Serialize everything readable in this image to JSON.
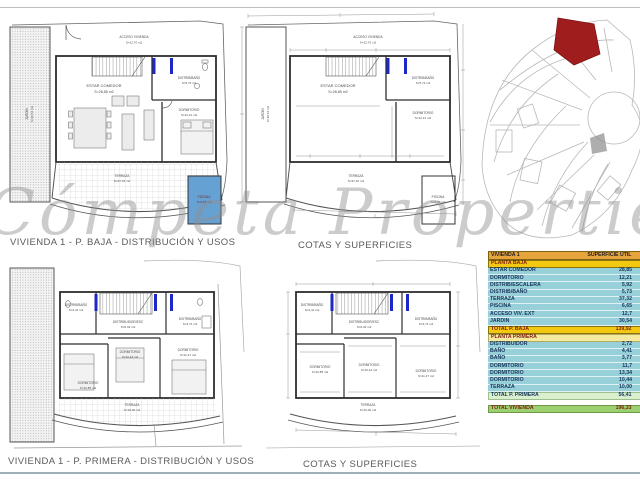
{
  "watermark": "Cómpeta Properties",
  "captions": {
    "pb_usos": "VIVIENDA 1 - P. BAJA - DISTRIBUCIÓN Y USOS",
    "pb_cotas": "COTAS Y SUPERFICIES",
    "pp_usos": "VIVIENDA 1 - P. PRIMERA - DISTRIBUCIÓN Y USOS",
    "pp_cotas": "COTAS Y SUPERFICIES"
  },
  "plans": {
    "pb": {
      "acceso": {
        "name": "ACCESO VIVIENDA",
        "area": "S=12,70 m2"
      },
      "jardin": {
        "name": "JARDÍN",
        "area": "S=30,54 m2"
      },
      "estar": {
        "name": "ESTAR COMEDOR",
        "area": "S=28,85 m2"
      },
      "distrib": {
        "name": "DISTRIB/BAÑO",
        "area": "S=5,73 m2"
      },
      "dorm": {
        "name": "DORMITORIO",
        "area": "S=12,21 m2"
      },
      "terraza": {
        "name": "TERRAZA",
        "area": "S=37,32 m2"
      },
      "piscina": {
        "name": "PISCINA",
        "area": "S=6,65 m2"
      }
    },
    "pp": {
      "bano_izq": {
        "name": "DISTRIB/BAÑO",
        "area": "S=4,41 m2"
      },
      "distribuidor": {
        "name": "DISTRIBUIDOR/ESC",
        "area": "S=6,02 m2"
      },
      "bano_der": {
        "name": "DISTRIB/BAÑO",
        "area": "S=3,74 m2"
      },
      "dorm_izq": {
        "name": "DORMITORIO",
        "area": "S=10,85 m2"
      },
      "dorm_centro": {
        "name": "DORMITORIO",
        "area": "S=10,44 m2"
      },
      "dorm_der": {
        "name": "DORMITORIO",
        "area": "S=11,27 m2"
      },
      "terraza": {
        "name": "TERRAZA",
        "area": "S=10,00 m2"
      }
    }
  },
  "table": {
    "headers": [
      "VIVIENDA 1",
      "SUPERFICIE ÚTIL",
      "SUP. CONSTRUIDA"
    ],
    "pb": {
      "title": "PLANTA BAJA",
      "rows": [
        [
          "ESTAR COMEDOR",
          "28,85",
          "60,03"
        ],
        [
          "DORMITORIO",
          "12,21",
          "0"
        ],
        [
          "DISTRIB/ESCALERA",
          "5,92",
          "0"
        ],
        [
          "DISTRIB/BAÑO",
          "5,73",
          "0"
        ],
        [
          "TERRAZA",
          "37,32",
          "0"
        ],
        [
          "PISCINA",
          "6,65",
          "0"
        ],
        [
          "ACCESO VIV. EXT",
          "12,7",
          "0"
        ],
        [
          "JARDIN",
          "30,54",
          "0"
        ]
      ],
      "total": [
        "TOTAL P. BAJA",
        "139,92",
        "60,03"
      ]
    },
    "pp": {
      "title": "PLANTA PRIMERA",
      "rows": [
        [
          "DISTRIBUIDOR",
          "2,72",
          "50,59"
        ],
        [
          "BAÑO",
          "4,41",
          "0"
        ],
        [
          "BAÑO",
          "3,77",
          "0"
        ],
        [
          "DORMITORIO",
          "11,7",
          "0"
        ],
        [
          "DORMITORIO",
          "13,34",
          "0"
        ],
        [
          "DORMITORIO",
          "10,44",
          "0"
        ],
        [
          "TERRAZA",
          "10,00",
          "0"
        ]
      ],
      "total": [
        "TOTAL P. PRIMERA",
        "56,41",
        "50,59"
      ]
    },
    "grand_total": [
      "TOTAL VIVIENDA",
      "196,33",
      "110,62"
    ]
  },
  "colors": {
    "pool": "#66a1d4",
    "highlight_plot": "#a01d1d",
    "table_header": "#e7a33c",
    "section_gold": "#f2c811",
    "row_teal": "#97d0d8",
    "grand_green": "#9cd06e"
  }
}
